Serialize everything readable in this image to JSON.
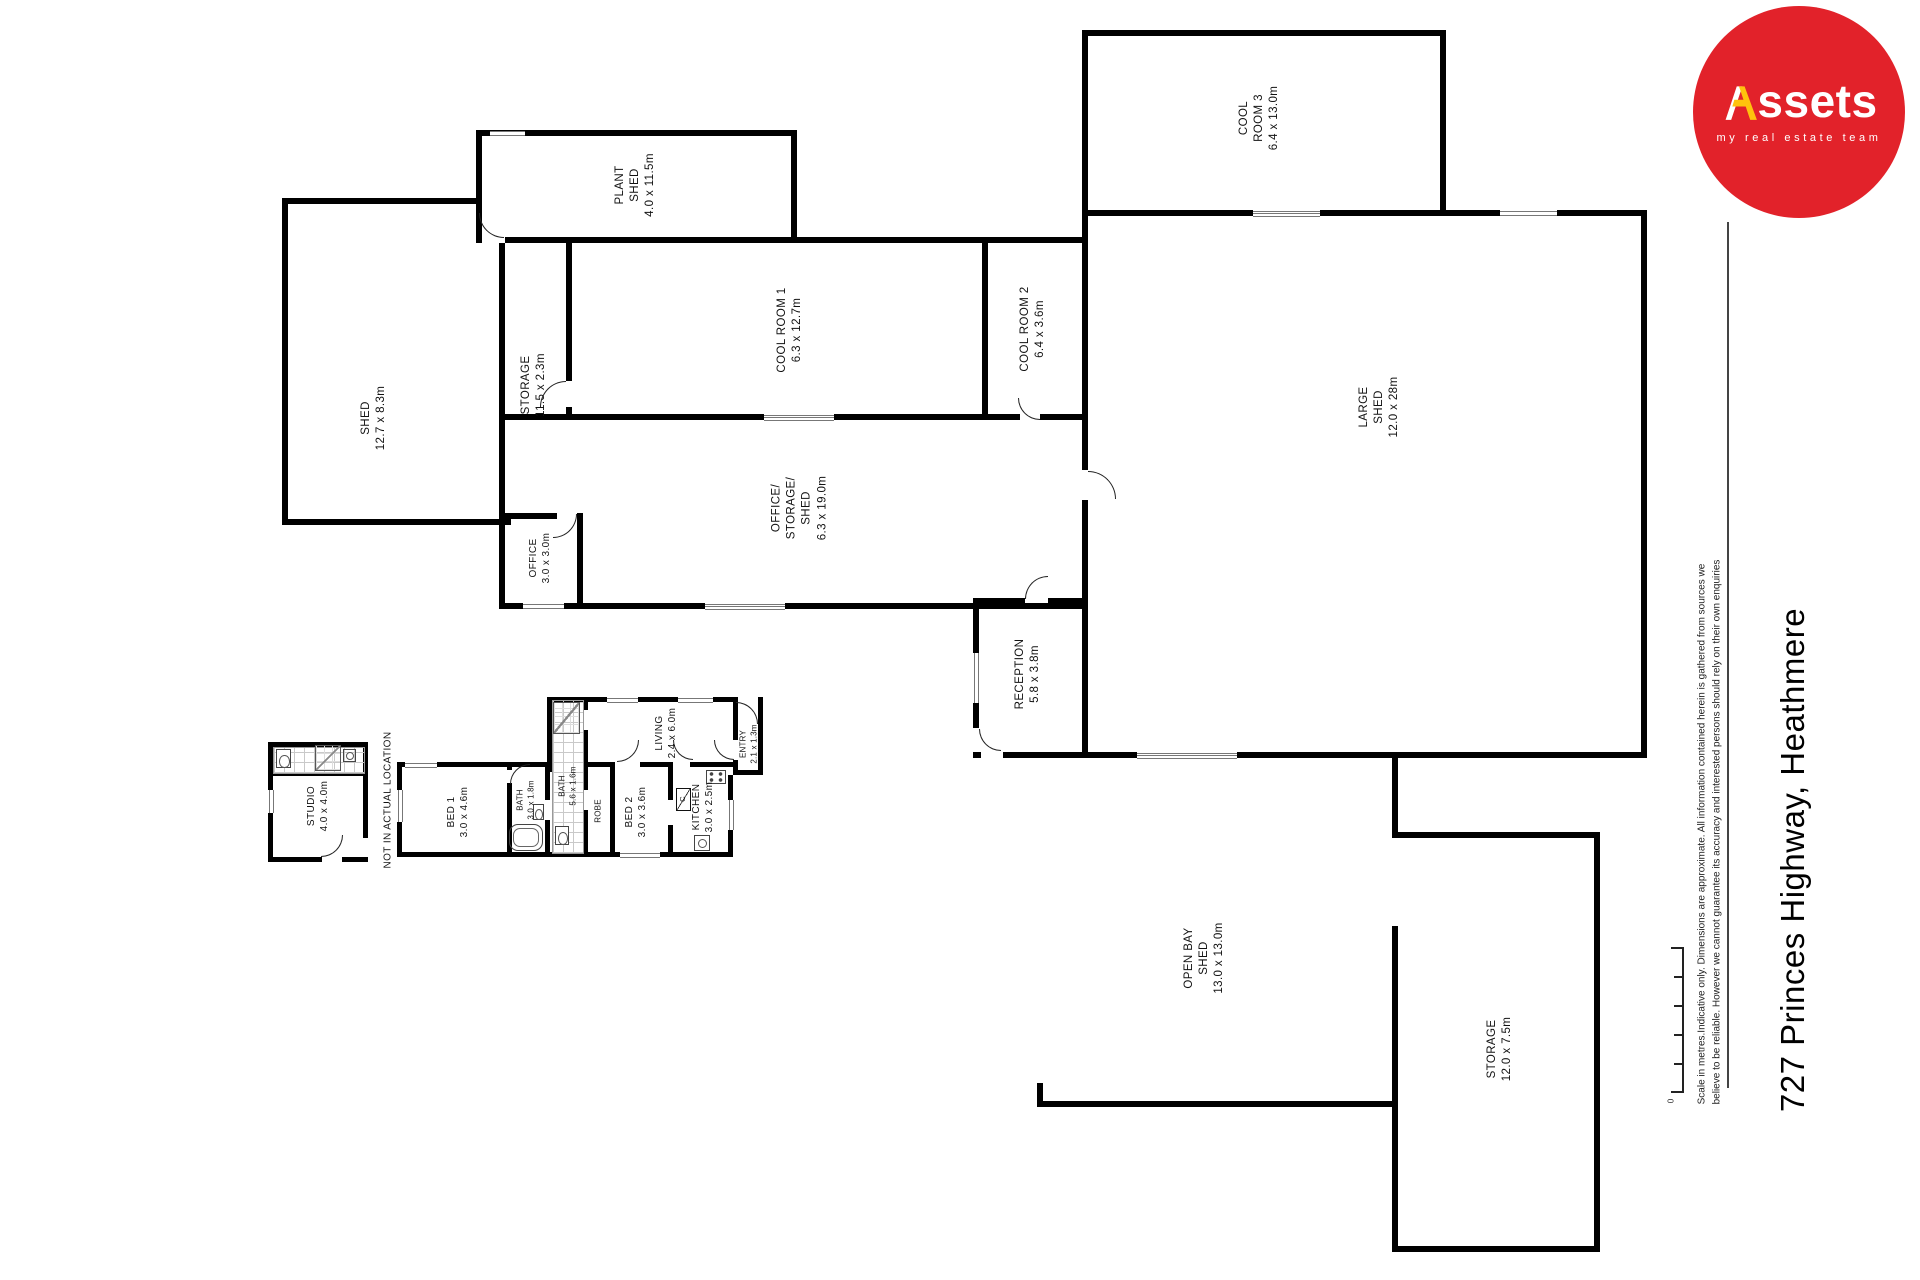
{
  "branding": {
    "logo_text_a": "A",
    "logo_text_rest": "ssets",
    "logo_tagline": "my real estate team",
    "brand_red": "#E2222A",
    "brand_yellow": "#FFC20D"
  },
  "title": {
    "address": "727 Princes Highway, Heathmere"
  },
  "disclaimer": {
    "line1": "Scale in metres.Indicative only. Dimensions are approximate. All information contained herein is gathered from sources we",
    "line2": "believe to be reliable. However we cannot guarantee its accuracy and interested persons should rely on their own enquiries"
  },
  "scale_bar": {
    "zero_label": "0"
  },
  "note": "NOT IN ACTUAL LOCATION",
  "rooms": {
    "plant_shed": {
      "lines": [
        "PLANT",
        "SHED",
        "4.0 x 11.5m"
      ]
    },
    "shed": {
      "lines": [
        "SHED",
        "12.7 x 8.3m"
      ]
    },
    "storage_corridor": {
      "lines": [
        "STORAGE",
        "11.5 x 2.3m"
      ]
    },
    "cool_room_1": {
      "lines": [
        "COOL ROOM 1",
        "6.3 x 12.7m"
      ]
    },
    "cool_room_2": {
      "lines": [
        "COOL ROOM 2",
        "6.4 x 3.6m"
      ]
    },
    "cool_room_3": {
      "lines": [
        "COOL",
        "ROOM 3",
        "6.4 x 13.0m"
      ]
    },
    "large_shed": {
      "lines": [
        "LARGE",
        "SHED",
        "12.0 x 28m"
      ]
    },
    "office_storage_shed": {
      "lines": [
        "OFFICE/",
        "STORAGE/",
        "SHED",
        "6.3 x 19.0m"
      ]
    },
    "office": {
      "lines": [
        "OFFICE",
        "3.0 x 3.0m"
      ]
    },
    "reception": {
      "lines": [
        "RECEPTION",
        "5.8 x 3.8m"
      ]
    },
    "open_bay_shed": {
      "lines": [
        "OPEN BAY",
        "SHED",
        "13.0 x 13.0m"
      ]
    },
    "storage_yard": {
      "lines": [
        "STORAGE",
        "12.0 x 7.5m"
      ]
    },
    "studio": {
      "lines": [
        "STUDIO",
        "4.0 x 4.0m"
      ]
    },
    "bed1": {
      "lines": [
        "BED 1",
        "3.0 x 4.6m"
      ]
    },
    "bed2": {
      "lines": [
        "BED 2",
        "3.0 x 3.6m"
      ]
    },
    "bath1": {
      "lines": [
        "BATH",
        "3.0 x 1.8m"
      ]
    },
    "bath2": {
      "lines": [
        "BATH",
        "5.6 x 1.6m"
      ]
    },
    "robe": {
      "lines": [
        "ROBE"
      ]
    },
    "kitchen": {
      "lines": [
        "KITCHEN",
        "3.0 x 2.5m"
      ]
    },
    "living": {
      "lines": [
        "LIVING",
        "2.4 x 6.0m"
      ]
    },
    "entry": {
      "lines": [
        "ENTRY",
        "2.1 x 1.3m"
      ]
    },
    "closet": {
      "lines": [
        "C"
      ]
    }
  }
}
